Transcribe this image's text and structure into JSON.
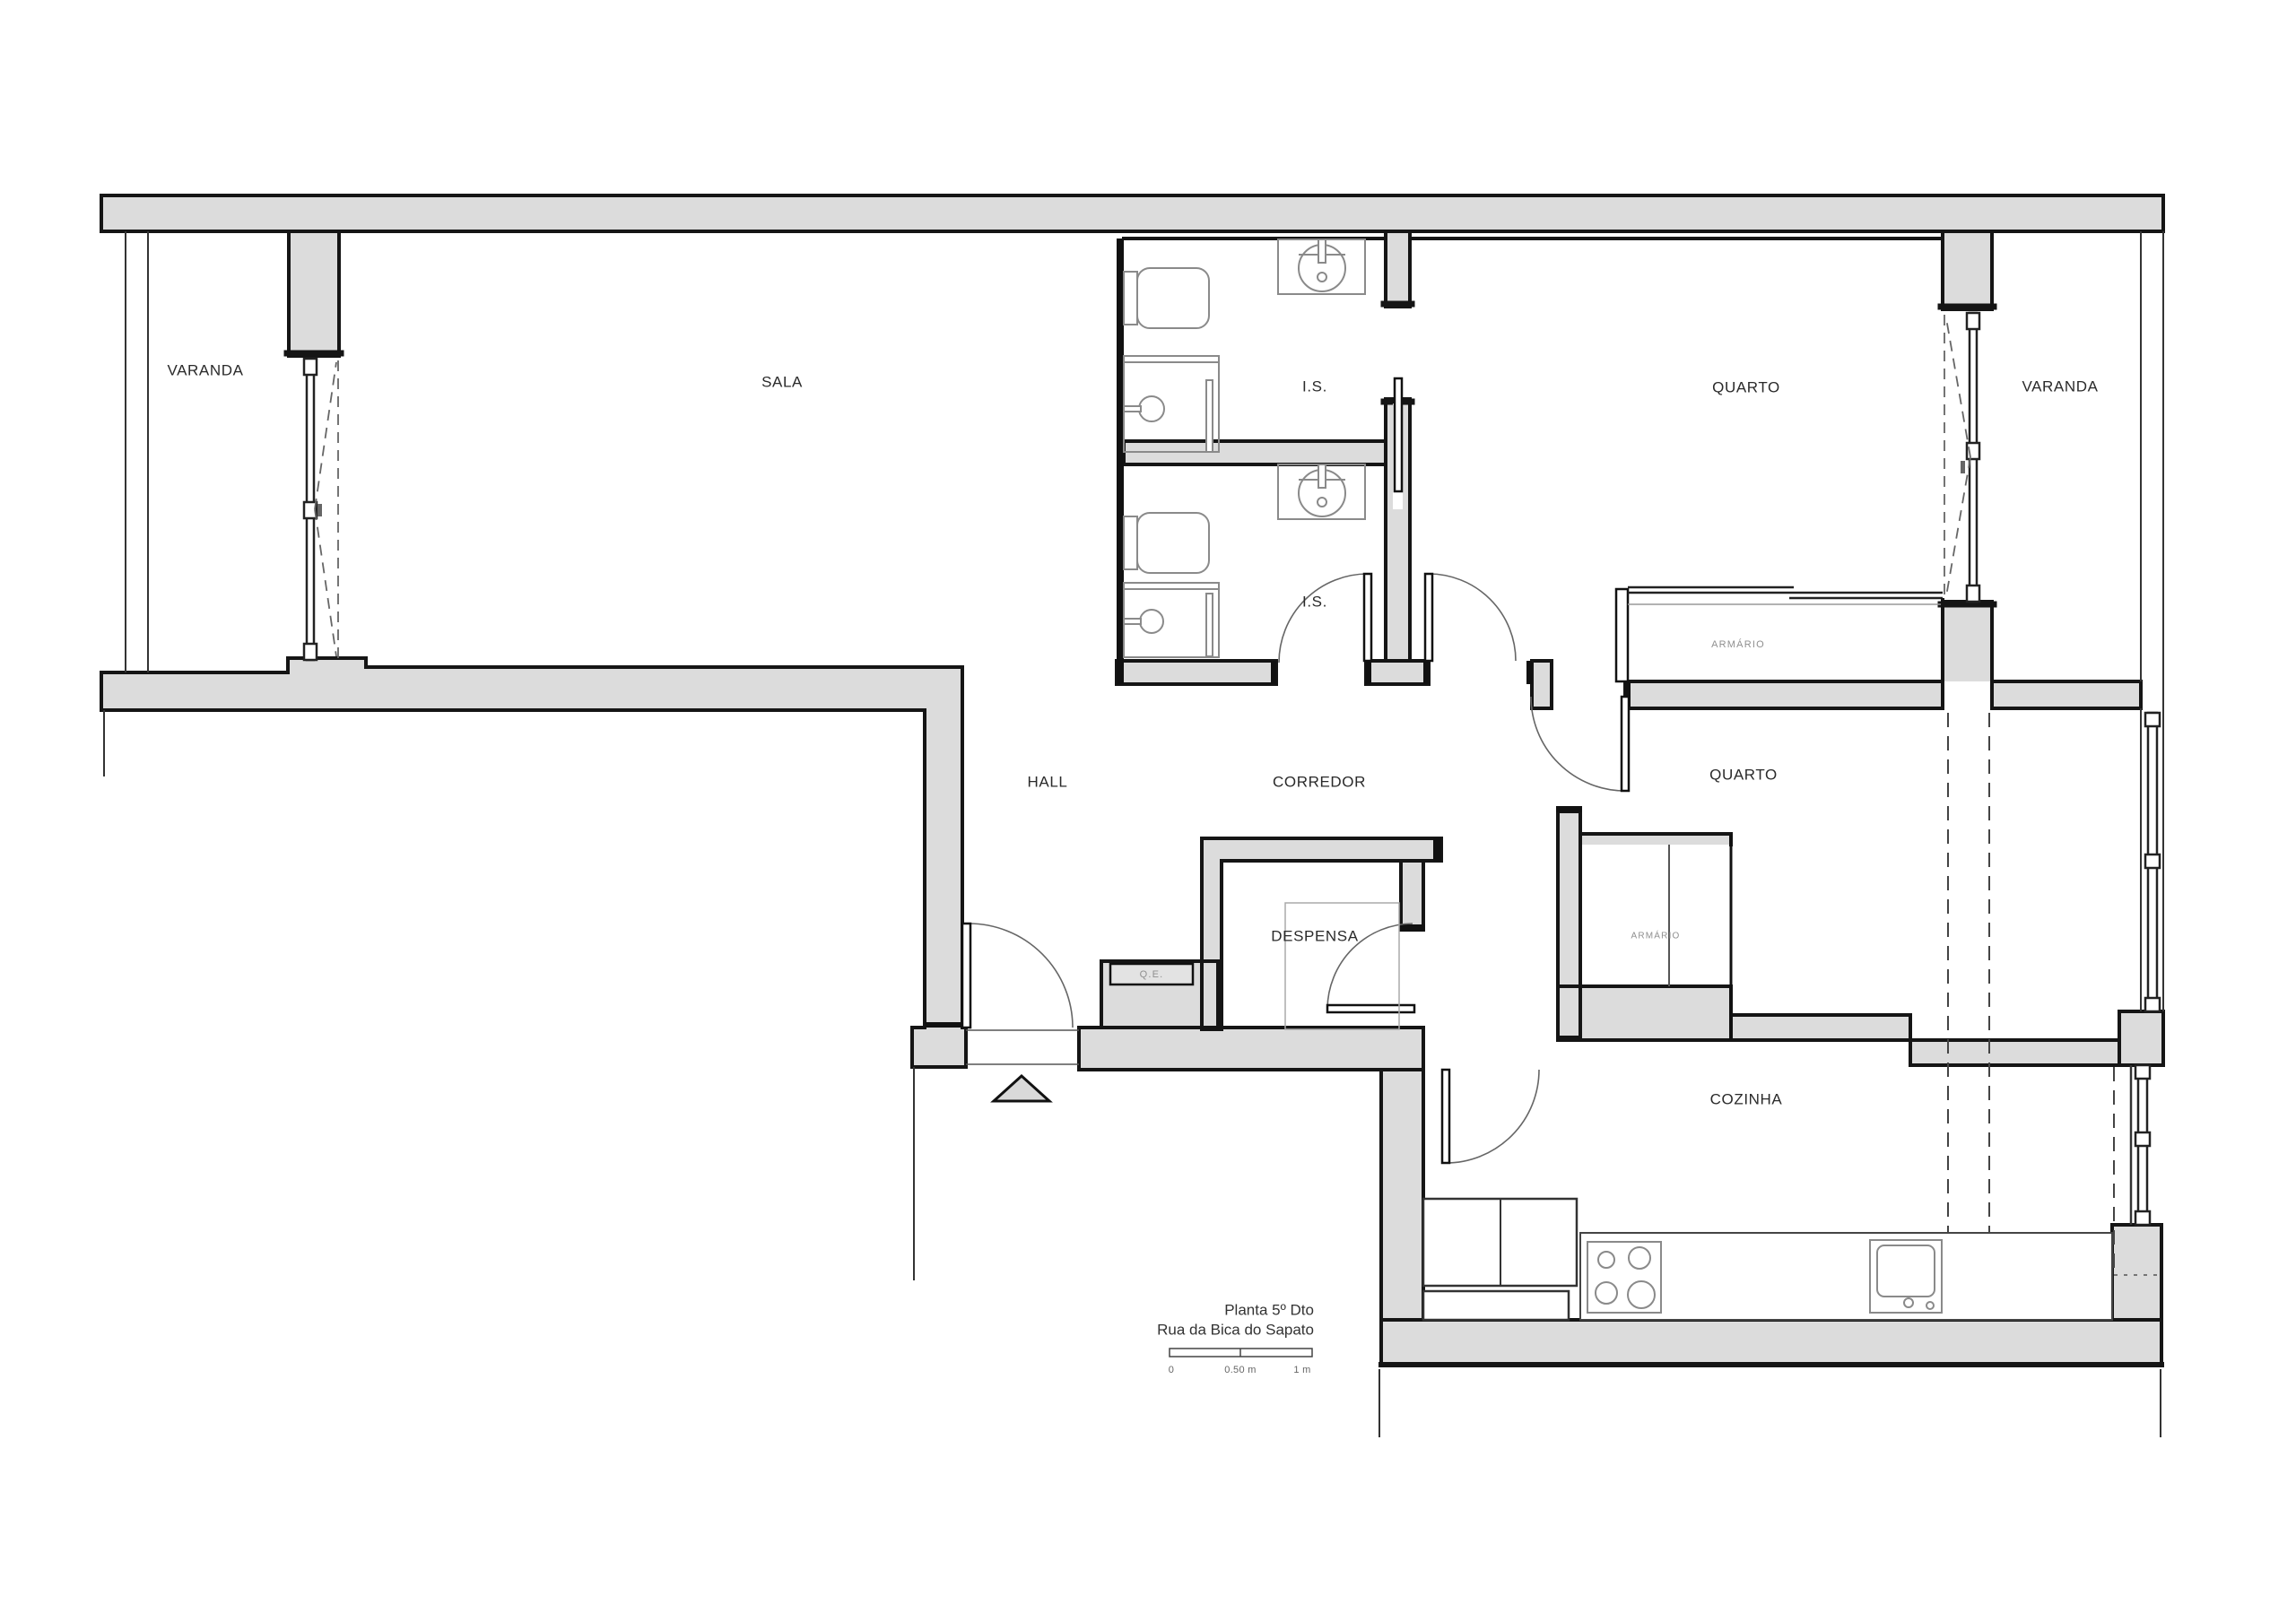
{
  "plan": {
    "rooms": {
      "varanda_left": "VARANDA",
      "sala": "SALA",
      "is_top": "I.S.",
      "quarto_top": "QUARTO",
      "varanda_right": "VARANDA",
      "is_bottom": "I.S.",
      "hall": "HALL",
      "corredor": "CORREDOR",
      "quarto_right": "QUARTO",
      "despensa": "DESPENSA",
      "cozinha": "COZINHA"
    },
    "annotations": {
      "armario_top": "ARMÁRIO",
      "armario_mid": "ARMÁRIO",
      "quadro_eletrico": "Q.E."
    },
    "title": {
      "line1": "Planta 5º Dto",
      "line2": "Rua da Bica do Sapato"
    },
    "scale_bar": {
      "start": "0",
      "middle": "0.50 m",
      "end": "1 m"
    },
    "colors": {
      "wall_fill": "#dcdcdc",
      "wall_stroke": "#151515",
      "fixture_stroke": "#8a8a8a",
      "label_text": "#2a2a2a",
      "small_label_text": "#8f8f8f"
    }
  }
}
